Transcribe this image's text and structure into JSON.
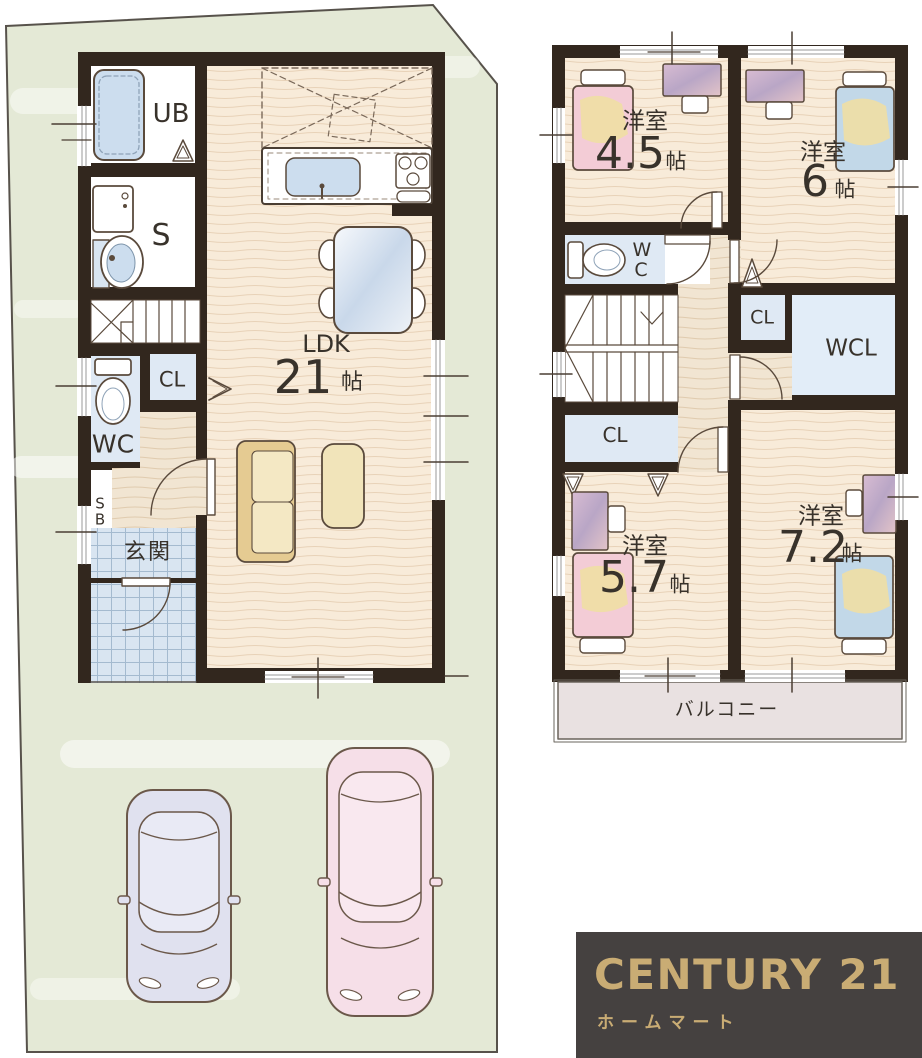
{
  "floor1": {
    "labels": {
      "bathroom": "UB",
      "sanitary": "S",
      "closet": "CL",
      "toilet": "WC",
      "shoe_box": "SB",
      "entrance": "玄関",
      "living": "LDK",
      "living_size": "21",
      "unit": "帖"
    }
  },
  "floor2": {
    "labels": {
      "room_a": "洋室",
      "room_a_size": "4.5",
      "room_b": "洋室",
      "room_b_size": "6",
      "room_c": "洋室",
      "room_c_size": "5.7",
      "room_d": "洋室",
      "room_d_size": "7.2",
      "unit": "帖",
      "toilet": "WC",
      "closet_mid": "CL",
      "walk_in_closet": "WCL",
      "closet_low": "CL",
      "balcony": "バルコニー"
    }
  },
  "logo": {
    "brand": "CENTURY 21",
    "company": "ホームマート"
  },
  "colors": {
    "wall": "#32271e",
    "lot_green": "#e4e9d6",
    "wood_floor": "#f8ebd9",
    "hall_floor": "#f1e5d2",
    "tile_blue": "#d9e5f1",
    "closet_blue": "#dfe9f4",
    "balcony_floor": "#e9e1e1",
    "bed_pink": "#f3ccd6",
    "bed_blue": "#c2d8e8",
    "blanket_yellow": "#f0dfa4",
    "sofa_tan": "#e5cb92",
    "car_blue": "#e0e1ef",
    "car_pink": "#f6dfe8",
    "logo_bg": "#454140",
    "logo_gold": "#c9ac74"
  }
}
